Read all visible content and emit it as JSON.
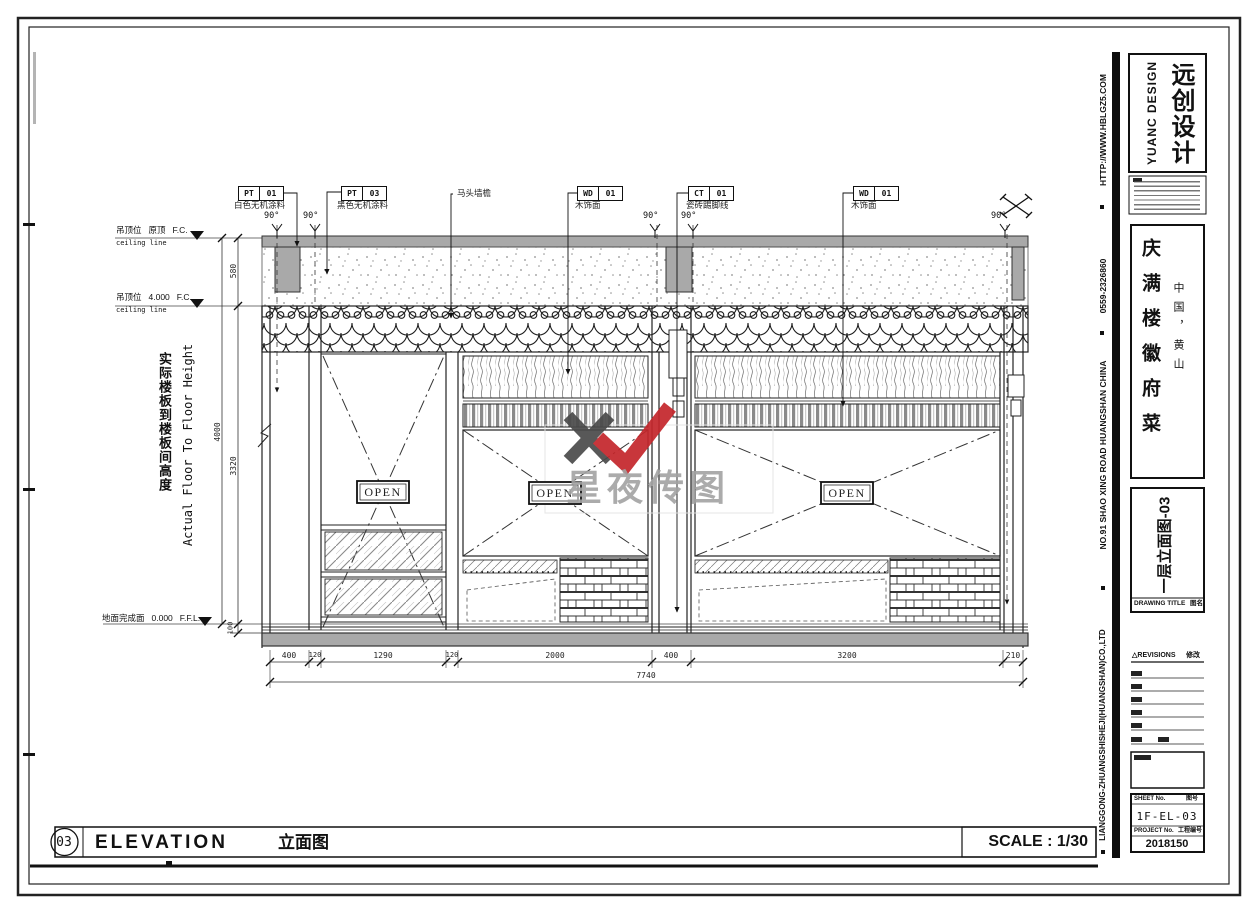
{
  "palette": {
    "line": "#1f1f1f",
    "slab_gray": "#a9a9a9",
    "accent_red": "#c4262b",
    "logo_dark": "#4a4a4a",
    "watermark_gray": "#a3a3a3"
  },
  "callouts": {
    "angle": "90°",
    "pt01": {
      "code": "PT",
      "num": "01",
      "desc": "白色无机涂料"
    },
    "pt03": {
      "code": "PT",
      "num": "03",
      "desc": "黑色无机涂料"
    },
    "matou": {
      "label": "马头墙檐"
    },
    "wd01a": {
      "code": "WD",
      "num": "01",
      "desc": "木饰面"
    },
    "ct01": {
      "code": "CT",
      "num": "01",
      "desc": "瓷砖踢脚线"
    },
    "wd01b": {
      "code": "WD",
      "num": "01",
      "desc": "木饰面"
    }
  },
  "levels": {
    "top": {
      "prefix": "吊顶位",
      "value": "原顶",
      "suffix": "F.C.",
      "sub": "ceiling line"
    },
    "mid": {
      "prefix": "吊顶位",
      "value": "4.000",
      "suffix": "F.C.",
      "sub": "ceiling line"
    },
    "floor": {
      "prefix": "地面完成面",
      "value": "0.000",
      "suffix": "F.F.L."
    }
  },
  "vdims": {
    "d580": "580",
    "d4000": "4000",
    "d3320": "3320",
    "d100": "100"
  },
  "hdims": {
    "list": [
      "400",
      "120",
      "1290",
      "120",
      "2000",
      "400",
      "3200",
      "210"
    ],
    "total": "7740"
  },
  "axis_note": {
    "cn": "实际楼板到楼板间高度",
    "en": "Actual Floor To Floor Height"
  },
  "open_label": "OPEN",
  "watermark": {
    "text": "星夜传图"
  },
  "footer": {
    "number": "03",
    "title_en": "ELEVATION",
    "title_cn": "立面图",
    "scale": "SCALE : 1/30"
  },
  "side_strip": {
    "website": "HTTP://WWW.HBLGZ5.COM",
    "phone": "0559-2326860",
    "address": "NO.91 SHAO XING ROAD HUANGSHAN CHINA",
    "company": "LIANGGONG-ZHUANGSHISHEJI(HUANGSHAN)CO.,LTD"
  },
  "titleblock": {
    "logo_cn": "远创设计",
    "logo_en": "YUANC DESIGN",
    "project_cn": "庆满楼徽府菜",
    "location": "中国，黄山",
    "drawing_no": "一层立面图-03",
    "drawing_title_label": "DRAWING TITLE",
    "drawing_title_cn": "图名",
    "revisions_mark": "△",
    "revisions_label": "REVISIONS",
    "revisions_cn": "修改",
    "sheet_label": "SHEET No.",
    "sheet_label_cn": "图号",
    "sheet_no": "1F-EL-03",
    "project_label": "PROJECT No.",
    "project_label_cn": "工程编号",
    "project_no": "2018150"
  }
}
